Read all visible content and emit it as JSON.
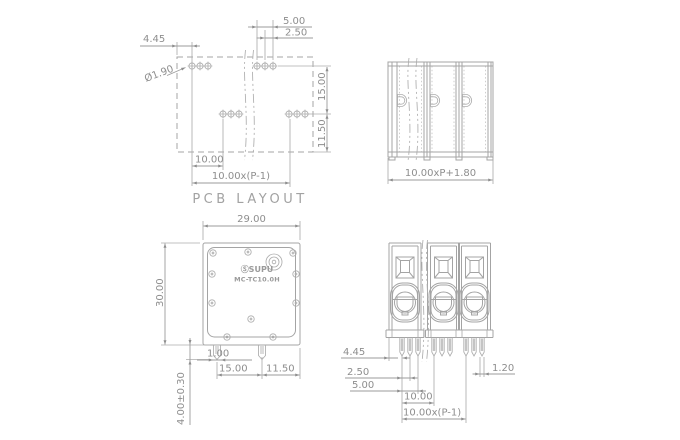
{
  "colors": {
    "line": "#a4a4a4",
    "dimension": "#8e8e8e",
    "background": "#ffffff"
  },
  "views": {
    "pcb_layout": {
      "caption": "PCB LAYOUT",
      "dims": {
        "edge_to_pin": "4.45",
        "pin_group_span": "5.00",
        "pin_spacing": "2.50",
        "hole_diameter": "Ø1.90",
        "row_spacing": "15.00",
        "row_to_edge": "11.50",
        "first_pitch": "10.00",
        "total_pitch": "10.00x(P-1)"
      }
    },
    "side_view": {
      "dims": {
        "total_width": "10.00xP+1.80"
      }
    },
    "top_view": {
      "brand": "ⓈSUPU",
      "model": "MC-TC10.0H",
      "dims": {
        "body_width": "29.00",
        "body_depth": "30.00",
        "pin_width": "1.00",
        "pin_spacing": "15.00",
        "pin_to_edge": "11.50",
        "pin_length": "4.00±0.30"
      }
    },
    "front_view": {
      "dims": {
        "edge_to_pin": "4.45",
        "pin_spacing": "2.50",
        "pin_group_span": "5.00",
        "pole_pitch": "10.00",
        "total_pitch": "10.00x(P-1)",
        "pin_width": "1.20"
      }
    }
  }
}
